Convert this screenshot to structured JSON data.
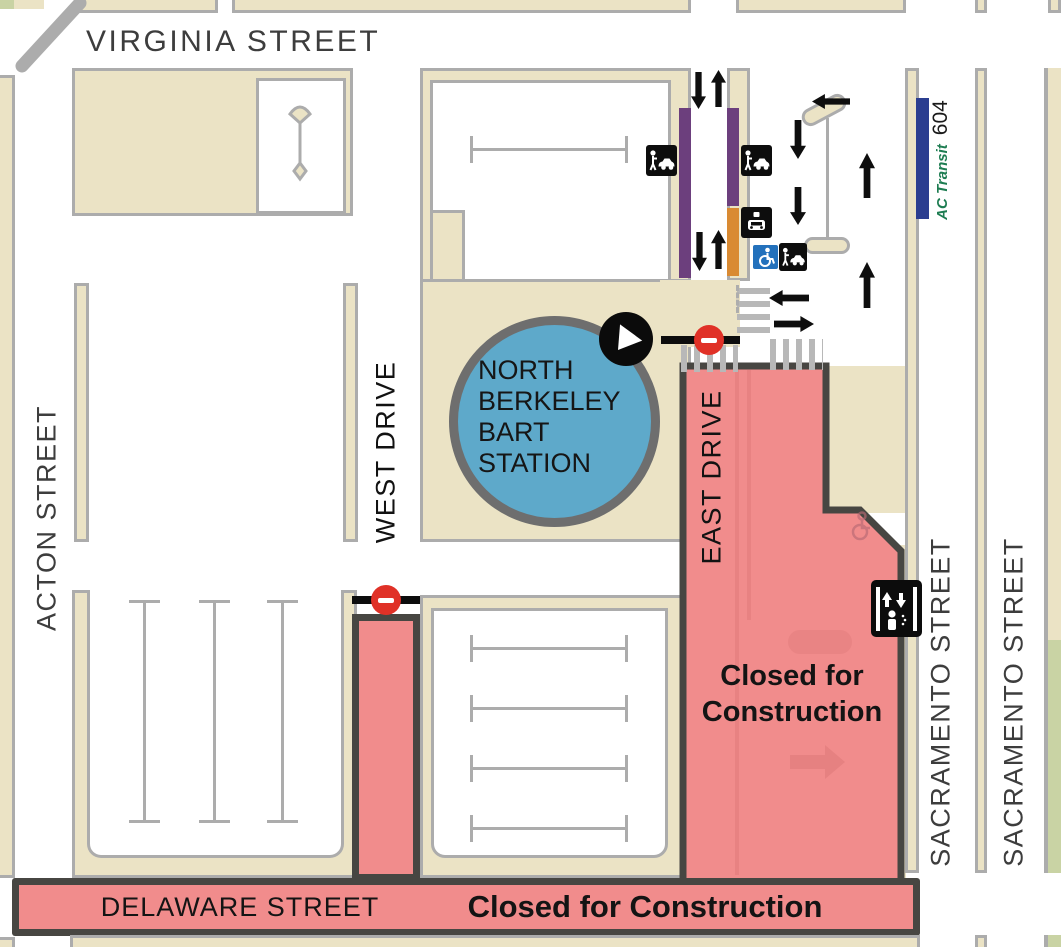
{
  "title": "North Berkeley BART Station construction access map",
  "streets": {
    "virginia": "VIRGINIA STREET",
    "acton": "ACTON STREET",
    "west_drive": "WEST DRIVE",
    "east_drive": "EAST DRIVE",
    "sacramento": "SACRAMENTO STREET",
    "delaware": "DELAWARE STREET"
  },
  "station": {
    "line1": "NORTH",
    "line2": "BERKELEY",
    "line3": "BART",
    "line4": "STATION"
  },
  "closure": {
    "line1": "Closed for",
    "line2": "Construction",
    "delaware_text": "Closed for Construction"
  },
  "transit": {
    "agency": "AC Transit",
    "route": "604"
  },
  "icons": [
    "kiss-and-ride",
    "taxi",
    "accessible-parking",
    "elevator",
    "bart-entrance",
    "no-entry",
    "ac-transit-bus-stop",
    "light-pole",
    "crosswalk",
    "traffic-arrow"
  ],
  "colors": {
    "closed_pink": "#F18C8C",
    "dark_outline": "#474642",
    "block_tan": "#EBE3C5",
    "curb_gray": "#ACACAC",
    "station_blue": "#5EA9CA",
    "bus_zone_purple": "#6C3F7D",
    "taxi_zone_orange": "#D98A33",
    "ac_transit_navy": "#2B3E90",
    "accessible_blue": "#2371BC",
    "no_entry_red": "#E03127",
    "landscape_green": "#C9D3A4"
  }
}
